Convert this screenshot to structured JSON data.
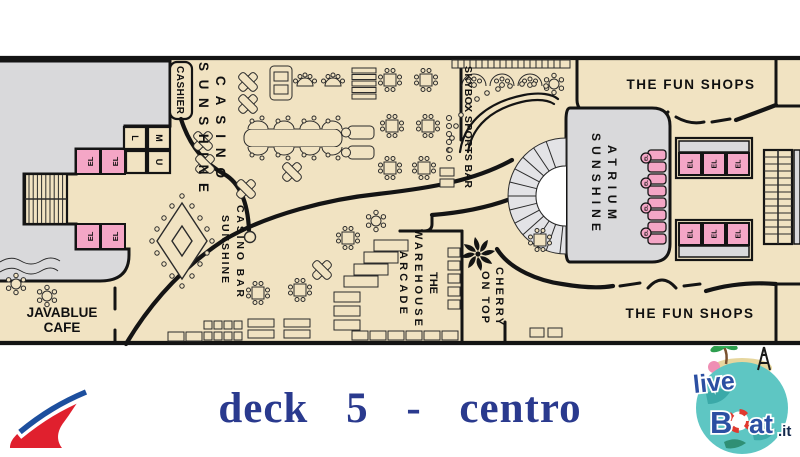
{
  "colors": {
    "floor": "#f1e3c2",
    "gray": "#d9d9db",
    "pink": "#f4a6c6",
    "wall": "#141414",
    "title": "#2a3a8e",
    "logo_blue": "#2b4fa2",
    "globe": "#5ec6c3",
    "carnival_red": "#e0202e",
    "carnival_blue": "#1d4f9e"
  },
  "title": {
    "text": "deck 5 - centro"
  },
  "plan": {
    "labels": {
      "cashier": "CASHIER",
      "casino_line1": "SUNSHINE",
      "casino_line2": "CASINO",
      "skybox": "SKYBOX SPORTS BAR",
      "atrium_line1": "SUNSHINE",
      "atrium_line2": "ATRIUM",
      "fun_shops_top": "THE FUN SHOPS",
      "fun_shops_bottom": "THE FUN  SHOPS",
      "warehouse_line1": "THE",
      "warehouse_line2": "WAREHOUSE",
      "warehouse_line3": "ARCADE",
      "cherry_line1": "CHERRY",
      "cherry_line2": "ON TOP",
      "casino_bar_line1": "SUNSHINE",
      "casino_bar_line2": "CASINO BAR",
      "javablue_line1": "JAVABLUE",
      "javablue_line2": "CAFE",
      "el": "EL",
      "stair_l": "L",
      "stair_m": "M",
      "stair_u": "U"
    }
  },
  "branding": {
    "liveboat": {
      "live": "live",
      "boat_b": "B",
      "boat_at": "at",
      "domain": ".it"
    }
  }
}
